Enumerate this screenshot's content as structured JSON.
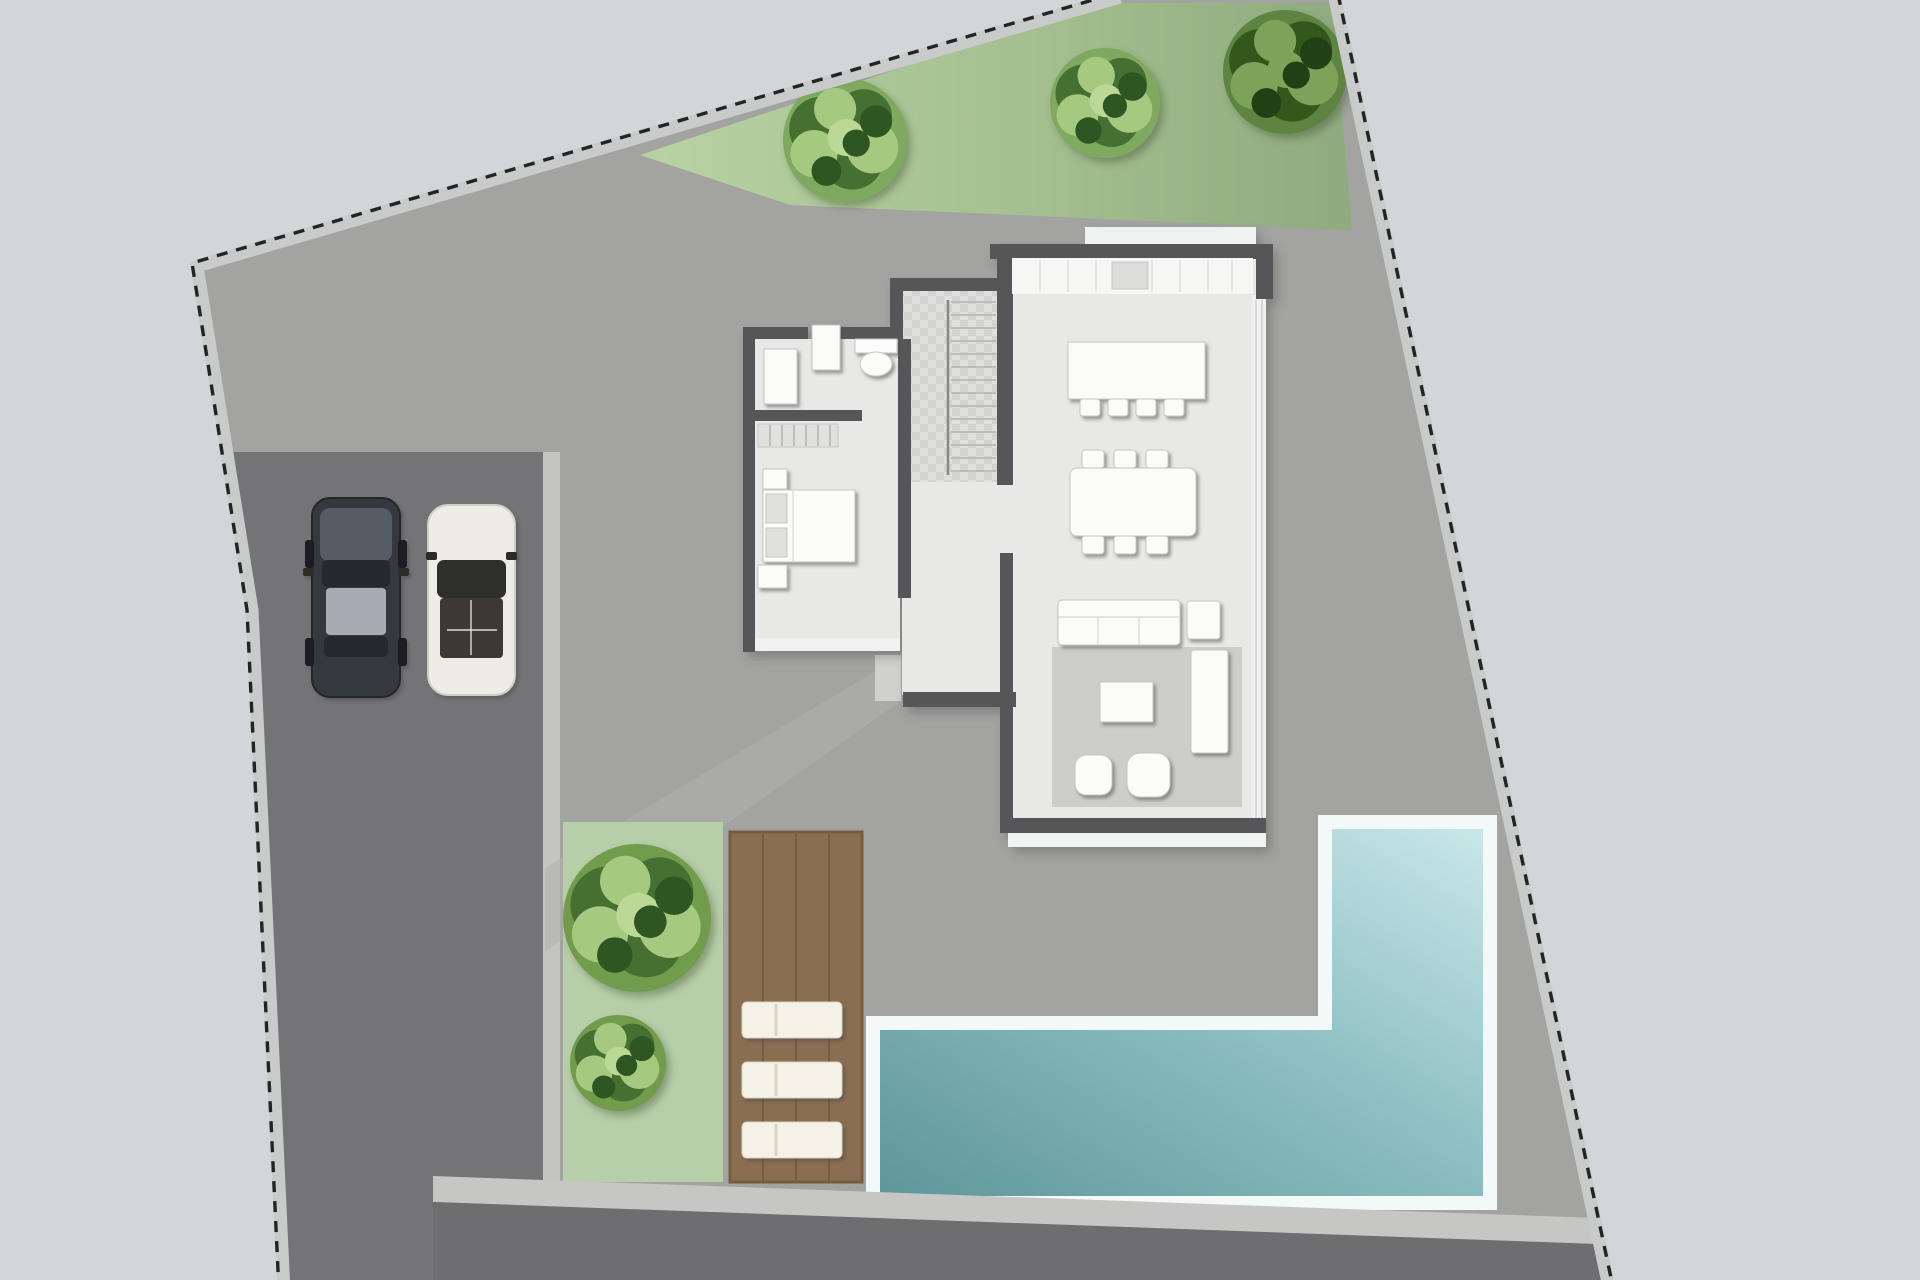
{
  "scene": {
    "kind": "residential-site-plan",
    "parcel_boundary_style": "dashed",
    "rooms": [
      "kitchen",
      "dining-area",
      "living-area",
      "stair-hall",
      "bathroom",
      "bedroom"
    ],
    "outdoor": [
      "grass-strip",
      "driveway",
      "garden-bed",
      "wood-deck",
      "l-shaped-pool",
      "sidewalk",
      "road"
    ],
    "vehicle_count": 2,
    "lounger_count": 3,
    "tree_count": 5
  },
  "colors": {
    "bg": "#d3d6d9",
    "yard": "#a3a3a1",
    "drive": "#747477",
    "road": "#6e6e70",
    "band": "#c6c6c4",
    "paleLine": "#c4c4c2",
    "pathway": "#b0b0ae",
    "entryStep": "#d0d0ce",
    "boundaryBand": "#c9cbcb",
    "boundaryDash": "#242424",
    "grassLight": "#b8d2a3",
    "grassDark": "#8fab7d",
    "gardenBed": "#b7cfa9",
    "deck": "#8a6e51",
    "deckLine": "#755c3e",
    "poolBorder": "#f3f8f8",
    "poolLight": "#c9e7e9",
    "poolDeep": "#5e979b",
    "wall": "#565658",
    "floor": "#e8e8e6",
    "floorAlt": "#e0e0de",
    "checkA": "#dfdfdd",
    "checkB": "#d3d3d1",
    "tread": "#b4b4b2",
    "rail": "#8a8a88",
    "counter": "#f6f6f4",
    "counterLine": "#dcdcda",
    "sink": "#dcdcda",
    "furniture": "#fbfbf9",
    "furnitureLine": "#c6c6c4",
    "rug": "#cdcdcb",
    "windowStrip": "#f0f2f1",
    "lounger": "#f7f2e8",
    "loungerSeam": "#d9d2c4",
    "treeBase": "#7fa95e",
    "treeDark": "#456f30",
    "treeLight": "#a6c980",
    "treeHigh": "#bcd896",
    "treeDeep": "#2f5722",
    "treeDarkBase": "#5d8440",
    "treeDarkClump": "#33591f",
    "treeDarkLight": "#7da35a",
    "bushBase": "#6f9c4c",
    "carDarkBody": "#34383d",
    "carDarkHood": "#565c66",
    "carDarkRoof": "#a7acb3",
    "carDarkGlass": "#26292d",
    "carWhiteBody": "#edece7",
    "carWhiteGlass": "#2e2d2b",
    "carWhiteSeat": "#3a3836"
  },
  "landscape": {
    "trees": [
      {
        "name": "grass-tree-1",
        "x": 845,
        "y": 140,
        "r": 62,
        "variant": "light",
        "layer": "top"
      },
      {
        "name": "grass-tree-2",
        "x": 1105,
        "y": 103,
        "r": 55,
        "variant": "light",
        "layer": "top"
      },
      {
        "name": "grass-tree-3",
        "x": 1285,
        "y": 72,
        "r": 62,
        "variant": "dark",
        "layer": "top"
      },
      {
        "name": "garden-bush-large",
        "x": 637,
        "y": 918,
        "r": 74,
        "variant": "bush",
        "layer": "garden"
      },
      {
        "name": "garden-bush-small",
        "x": 618,
        "y": 1063,
        "r": 48,
        "variant": "bush",
        "layer": "garden"
      }
    ]
  }
}
